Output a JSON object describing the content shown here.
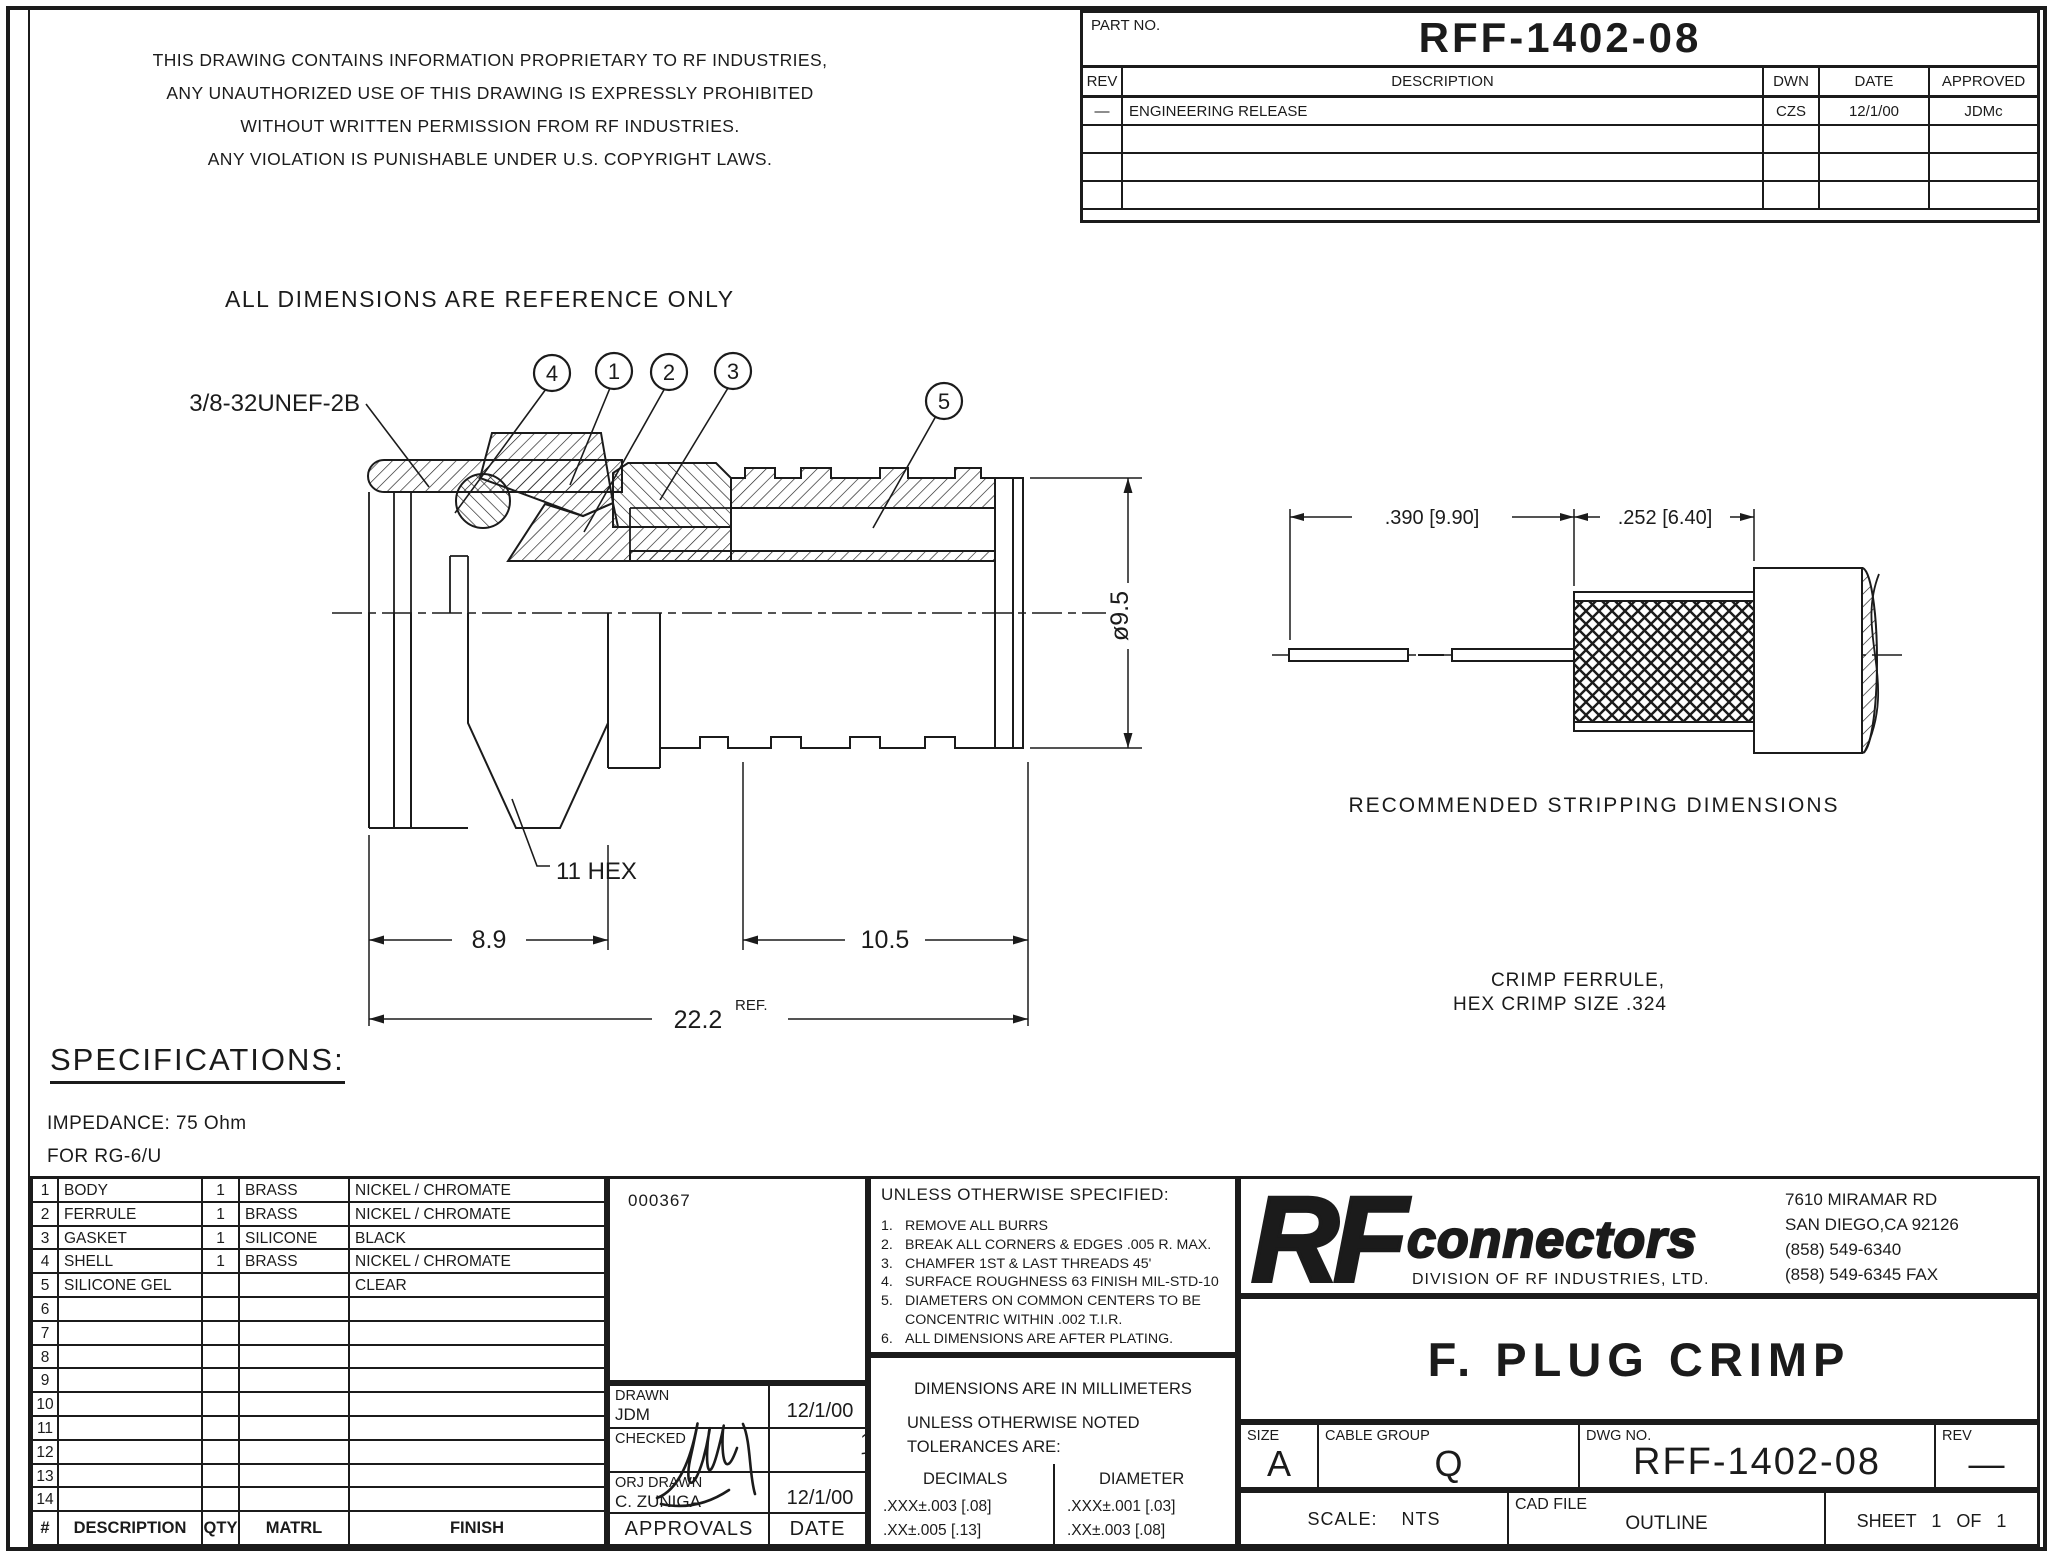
{
  "sheet": {
    "proprietary": [
      "THIS DRAWING CONTAINS INFORMATION PROPRIETARY TO RF INDUSTRIES,",
      "ANY UNAUTHORIZED USE OF THIS DRAWING IS EXPRESSLY PROHIBITED",
      "WITHOUT WRITTEN PERMISSION FROM RF INDUSTRIES.",
      "ANY VIOLATION IS PUNISHABLE UNDER U.S. COPYRIGHT LAWS."
    ],
    "reference_note": "ALL DIMENSIONS ARE REFERENCE ONLY"
  },
  "rev_table": {
    "part_no_label": "PART NO.",
    "part_no": "RFF-1402-08",
    "headers": {
      "rev": "REV",
      "description": "DESCRIPTION",
      "dwn": "DWN",
      "date": "DATE",
      "approved": "APPROVED"
    },
    "rows": [
      {
        "rev": "—",
        "description": "ENGINEERING RELEASE",
        "dwn": "CZS",
        "date": "12/1/00",
        "approved": "JDMc"
      }
    ]
  },
  "drawing": {
    "thread_label": "3/8-32UNEF-2B",
    "balloons": [
      "4",
      "1",
      "2",
      "3",
      "5"
    ],
    "hex_note": "11 HEX",
    "dim_hex_len": "8.9",
    "dim_ferrule_len": "10.5",
    "dim_overall": "22.2",
    "dim_overall_suffix": "REF.",
    "dim_diameter": "ø9.5"
  },
  "stripping": {
    "dim_left": ".390 [9.90]",
    "dim_right": ".252 [6.40]",
    "caption": "RECOMMENDED STRIPPING DIMENSIONS",
    "note_line1": "CRIMP FERRULE,",
    "note_line2": "HEX CRIMP SIZE .324"
  },
  "specs": {
    "title": "SPECIFICATIONS:",
    "line1": "IMPEDANCE: 75 Ohm",
    "line2": "FOR RG-6/U"
  },
  "parts_table": {
    "footer": {
      "num": "#",
      "description": "DESCRIPTION",
      "qty": "QTY",
      "matrl": "MATRL",
      "finish": "FINISH"
    },
    "rows": [
      {
        "num": "1",
        "description": "BODY",
        "qty": "1",
        "matrl": "BRASS",
        "finish": "NICKEL  /  CHROMATE"
      },
      {
        "num": "2",
        "description": "FERRULE",
        "qty": "1",
        "matrl": "BRASS",
        "finish": "NICKEL  /  CHROMATE"
      },
      {
        "num": "3",
        "description": "GASKET",
        "qty": "1",
        "matrl": "SILICONE",
        "finish": "BLACK"
      },
      {
        "num": "4",
        "description": "SHELL",
        "qty": "1",
        "matrl": "BRASS",
        "finish": "NICKEL  /  CHROMATE"
      },
      {
        "num": "5",
        "description": "SILICONE GEL",
        "qty": "",
        "matrl": "",
        "finish": "CLEAR"
      },
      {
        "num": "6",
        "description": "",
        "qty": "",
        "matrl": "",
        "finish": ""
      },
      {
        "num": "7",
        "description": "",
        "qty": "",
        "matrl": "",
        "finish": ""
      },
      {
        "num": "8",
        "description": "",
        "qty": "",
        "matrl": "",
        "finish": ""
      },
      {
        "num": "9",
        "description": "",
        "qty": "",
        "matrl": "",
        "finish": ""
      },
      {
        "num": "10",
        "description": "",
        "qty": "",
        "matrl": "",
        "finish": ""
      },
      {
        "num": "11",
        "description": "",
        "qty": "",
        "matrl": "",
        "finish": ""
      },
      {
        "num": "12",
        "description": "",
        "qty": "",
        "matrl": "",
        "finish": ""
      },
      {
        "num": "13",
        "description": "",
        "qty": "",
        "matrl": "",
        "finish": ""
      },
      {
        "num": "14",
        "description": "",
        "qty": "",
        "matrl": "",
        "finish": ""
      }
    ]
  },
  "doc_code": "000367",
  "approvals": {
    "drawn_label": "DRAWN",
    "drawn_name": "JDM",
    "drawn_date": "12/1/00",
    "checked_label": "CHECKED",
    "checked_sig_date": "12·1·00",
    "orig_label": "ORJ DRAWN",
    "orig_name": "C. ZUNIGA",
    "orig_date": "12/1/00",
    "footer_left": "APPROVALS",
    "footer_right": "DATE"
  },
  "notes": {
    "title": "UNLESS OTHERWISE SPECIFIED:",
    "items": [
      {
        "n": "1.",
        "t": "REMOVE ALL BURRS"
      },
      {
        "n": "2.",
        "t": "BREAK ALL CORNERS & EDGES .005 R. MAX."
      },
      {
        "n": "3.",
        "t": "CHAMFER 1ST & LAST THREADS 45'"
      },
      {
        "n": "4.",
        "t": "SURFACE ROUGHNESS 63 FINISH MIL-STD-10"
      },
      {
        "n": "5.",
        "t": "DIAMETERS ON COMMON CENTERS TO BE CONCENTRIC WITHIN .002 T.I.R."
      },
      {
        "n": "6.",
        "t": "ALL DIMENSIONS ARE AFTER PLATING."
      }
    ]
  },
  "tolerances": {
    "line1": "DIMENSIONS ARE IN MILLIMETERS",
    "line2": "UNLESS OTHERWISE NOTED",
    "line3": "TOLERANCES ARE:",
    "decimals_label": "DECIMALS",
    "decimals1": ".XXX±.003 [.08]",
    "decimals2": ".XX±.005 [.13]",
    "diameter_label": "DIAMETER",
    "diameter1": ".XXX±.001 [.03]",
    "diameter2": ".XX±.003 [.08]"
  },
  "company": {
    "logo_main": "RF",
    "logo_sub": "connectors",
    "division": "DIVISION OF RF INDUSTRIES, LTD.",
    "address_lines": [
      "7610 MIRAMAR RD",
      "SAN DIEGO,CA 92126",
      "(858) 549-6340",
      "(858) 549-6345 FAX"
    ]
  },
  "title_block": {
    "title": "F. PLUG CRIMP",
    "size_label": "SIZE",
    "size": "A",
    "cable_group_label": "CABLE GROUP",
    "cable_group": "Q",
    "dwg_label": "DWG NO.",
    "dwg_no": "RFF-1402-08",
    "rev_label": "REV",
    "rev": "—",
    "scale_label": "SCALE:",
    "scale": "NTS",
    "cad_label": "CAD FILE",
    "cad_file": "OUTLINE",
    "sheet_label": "SHEET",
    "sheet": "1 OF 1"
  }
}
